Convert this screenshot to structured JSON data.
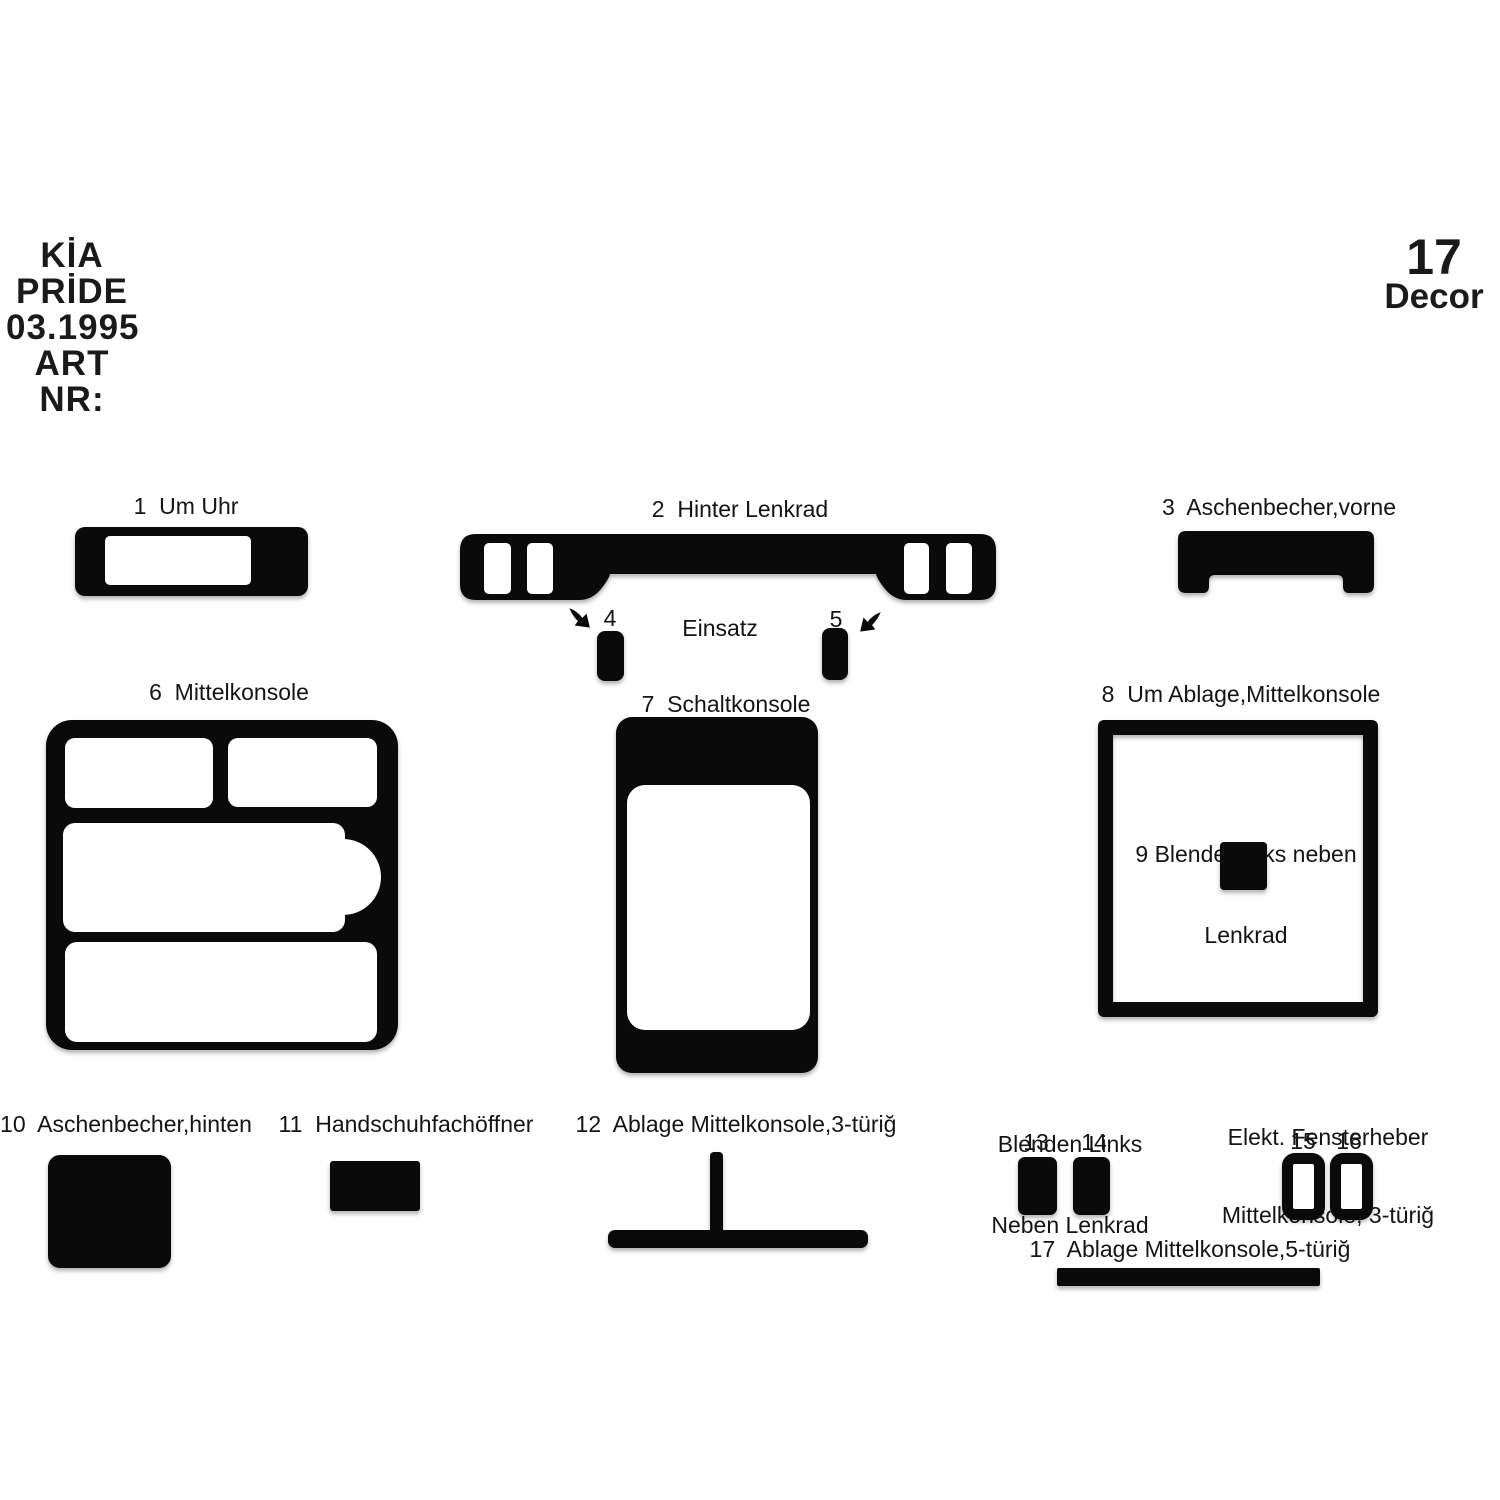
{
  "title_block": {
    "brand": "KİA",
    "model": "PRİDE",
    "date": "03.1995",
    "art_label": "ART NR:"
  },
  "decor_badge": {
    "count": "17",
    "word": "Decor"
  },
  "labels": {
    "p1": "1  Um Uhr",
    "p2": "2  Hinter Lenkrad",
    "p3": "3  Aschenbecher,vorne",
    "p4": "4",
    "p5": "5",
    "einsatz": "Einsatz",
    "p6": "6  Mittelkonsole",
    "p7": "7  Schaltkonsole",
    "p8": "8  Um Ablage,Mittelkonsole",
    "p9_line1": "9 Blende Links neben",
    "p9_line2": "Lenkrad",
    "p10": "10  Aschenbecher,hinten",
    "p11": "11  Handschuhfachöffner",
    "p12": "12  Ablage Mittelkonsole,3-türiğ",
    "p13_14_line1": "Blenden Links",
    "p13_14_line2": "Neben Lenkrad",
    "p13": "13",
    "p14": "14",
    "p15_16_line1": "Elekt. Fensterheber",
    "p15_16_line2": "Mittelkonsole, 3-türiğ",
    "p15": "15",
    "p16": "16",
    "p17": "17  Ablage Mittelkonsole,5-türiğ"
  },
  "icons": {
    "callout_arrow_left": "curved-pointer-arrow-down-right",
    "callout_arrow_right": "curved-pointer-arrow-down-left"
  },
  "colors": {
    "background": "#ffffff",
    "part_fill": "#0a0a0a",
    "text": "#141414"
  }
}
